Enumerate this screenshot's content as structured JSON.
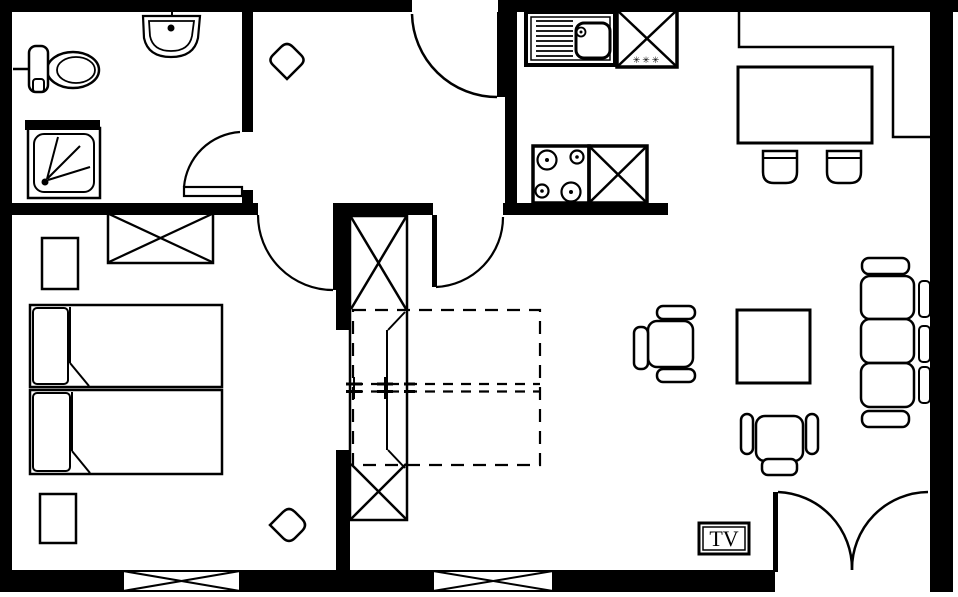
{
  "labels": {
    "tv": "TV",
    "freezer_marks": "✳✳✳"
  },
  "colors": {
    "line": "#000000",
    "background": "#ffffff"
  }
}
